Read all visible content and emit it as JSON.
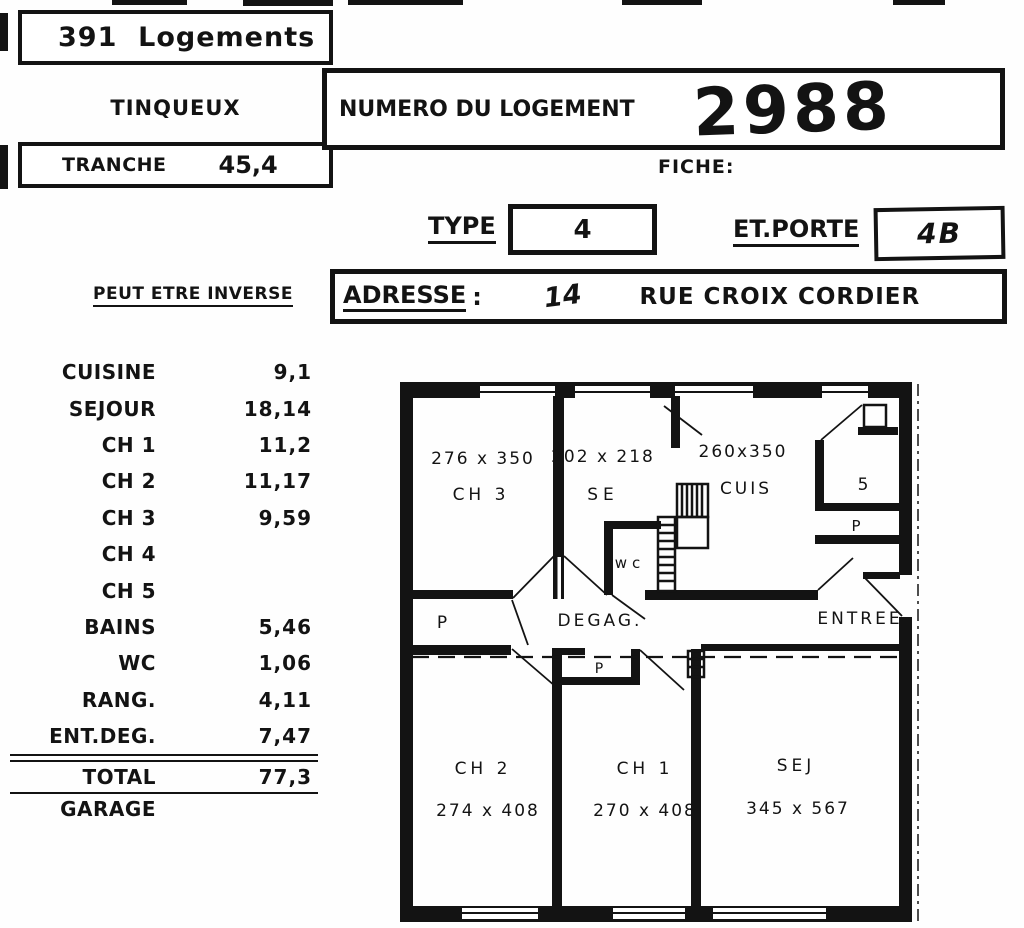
{
  "header": {
    "logements": "391  Logements",
    "city": "TINQUEUX",
    "tranche_label": "TRANCHE",
    "tranche_value": "45,4",
    "numero_label": "NUMERO DU LOGEMENT",
    "numero_value": "2988",
    "fiche_label": "FICHE:",
    "type_label": "TYPE",
    "type_value": "4",
    "etporte_label": "ET.PORTE",
    "etporte_value": "4B",
    "inverse_note": "PEUT ETRE INVERSE",
    "adresse_label": "ADRESSE",
    "adresse_colon": ":",
    "adresse_number": "14",
    "adresse_street": "RUE CROIX CORDIER"
  },
  "rooms": {
    "rows": [
      {
        "label": "CUISINE",
        "value": "9,1"
      },
      {
        "label": "SEJOUR",
        "value": "18,14"
      },
      {
        "label": "CH 1",
        "value": "11,2"
      },
      {
        "label": "CH 2",
        "value": "11,17"
      },
      {
        "label": "CH 3",
        "value": "9,59"
      },
      {
        "label": "CH 4",
        "value": ""
      },
      {
        "label": "CH 5",
        "value": ""
      },
      {
        "label": "BAINS",
        "value": "5,46"
      },
      {
        "label": "WC",
        "value": "1,06"
      },
      {
        "label": "RANG.",
        "value": "4,11"
      },
      {
        "label": "ENT.DEG.",
        "value": "7,47"
      }
    ],
    "total": {
      "label": "TOTAL",
      "value": "77,3"
    },
    "garage": {
      "label": "GARAGE",
      "value": ""
    }
  },
  "floorplan": {
    "rooms": {
      "ch3": {
        "dims": "276 x 350",
        "name": "CH 3"
      },
      "se": {
        "dims": "202 x 218",
        "name": "SE"
      },
      "cuis": {
        "dims": "260x350",
        "name": "CUIS"
      },
      "wc": {
        "name": "wc"
      },
      "s_closet": {
        "name": "5"
      },
      "p_right": {
        "name": "P"
      },
      "p_left": {
        "name": "P"
      },
      "p_mid": {
        "name": "P"
      },
      "degag": {
        "name": "DEGAG."
      },
      "entree": {
        "name": "ENTREE"
      },
      "ch2": {
        "name": "CH 2",
        "dims": "274 x 408"
      },
      "ch1": {
        "name": "CH 1",
        "dims": "270 x 408"
      },
      "sej": {
        "name": "SEJ",
        "dims": "345 x 567"
      }
    }
  },
  "colors": {
    "ink": "#131313",
    "paper": "#fefefe"
  }
}
